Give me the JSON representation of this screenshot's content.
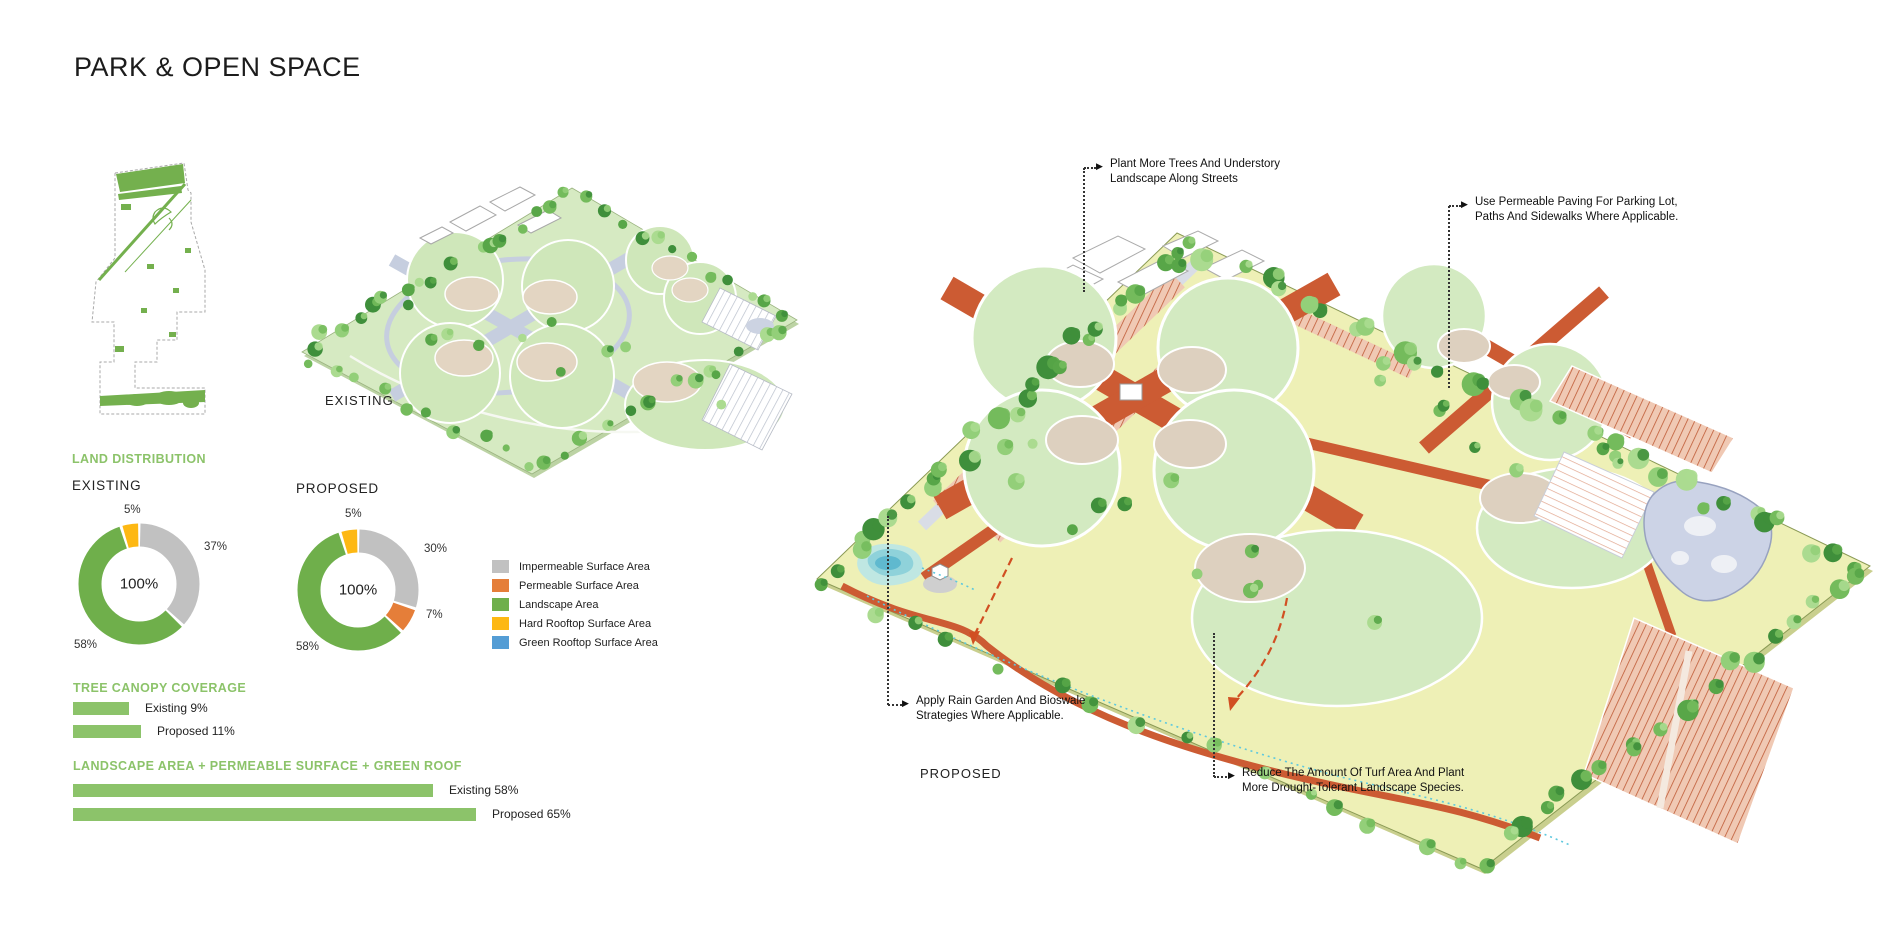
{
  "page": {
    "title": "PARK & OPEN SPACE"
  },
  "plans": {
    "existing_label": "EXISTING",
    "proposed_label": "PROPOSED"
  },
  "colors": {
    "heading_green": "#8CC36A",
    "bar_green": "#8CC36A",
    "impermeable_gray": "#C1C1C1",
    "permeable_orange": "#E57E39",
    "landscape_green": "#6FAF4B",
    "hard_rooftop_yellow": "#FDB813",
    "green_rooftop_blue": "#549DD5",
    "proposed_path_orange": "#CC5B33",
    "proposed_turf": "#EEF0B6",
    "existing_ground": "#D6EAC2",
    "leader_black": "#333333"
  },
  "land_distribution": {
    "heading": "LAND DISTRIBUTION",
    "existing": {
      "label": "EXISTING",
      "center": "100%",
      "segments": [
        {
          "name": "Impermeable Surface Area",
          "value": 37,
          "display": "37%",
          "color": "#C1C1C1"
        },
        {
          "name": "Landscape Area",
          "value": 58,
          "display": "58%",
          "color": "#6FAF4B"
        },
        {
          "name": "Hard Rooftop Surface Area",
          "value": 5,
          "display": "5%",
          "color": "#FDB813"
        }
      ]
    },
    "proposed": {
      "label": "PROPOSED",
      "center": "100%",
      "segments": [
        {
          "name": "Impermeable Surface Area",
          "value": 30,
          "display": "30%",
          "color": "#C1C1C1"
        },
        {
          "name": "Permeable Surface Area",
          "value": 7,
          "display": "7%",
          "color": "#E57E39"
        },
        {
          "name": "Landscape Area",
          "value": 58,
          "display": "58%",
          "color": "#6FAF4B"
        },
        {
          "name": "Hard Rooftop Surface Area",
          "value": 5,
          "display": "5%",
          "color": "#FDB813"
        }
      ]
    }
  },
  "legend": {
    "items": [
      {
        "label": "Impermeable Surface Area",
        "color": "#C1C1C1"
      },
      {
        "label": "Permeable Surface Area",
        "color": "#E57E39"
      },
      {
        "label": "Landscape Area",
        "color": "#6FAF4B"
      },
      {
        "label": "Hard Rooftop Surface Area",
        "color": "#FDB813"
      },
      {
        "label": "Green Rooftop Surface Area",
        "color": "#549DD5"
      }
    ]
  },
  "tree_canopy": {
    "heading": "TREE CANOPY COVERAGE",
    "bars": [
      {
        "label": "Existing 9%",
        "value": 9
      },
      {
        "label": "Proposed 11%",
        "value": 11
      }
    ]
  },
  "landscape_combined": {
    "heading": "LANDSCAPE AREA + PERMEABLE SURFACE + GREEN ROOF",
    "bars": [
      {
        "label": "Existing 58%",
        "value": 58
      },
      {
        "label": "Proposed 65%",
        "value": 65
      }
    ]
  },
  "annotations": {
    "plant_trees": {
      "line1": "Plant More Trees And Understory",
      "line2": "Landscape Along Streets"
    },
    "permeable_paving": {
      "line1": "Use Permeable Paving For Parking Lot,",
      "line2": "Paths And Sidewalks Where Applicable."
    },
    "rain_garden": {
      "line1": "Apply Rain Garden And Bioswale",
      "line2": "Strategies Where Applicable."
    },
    "reduce_turf": {
      "line1": "Reduce The Amount Of Turf Area And Plant",
      "line2": "More Drought-Tolerant Landscape Species."
    }
  },
  "chart_data": [
    {
      "type": "pie",
      "title": "Land Distribution — Existing",
      "labels": [
        "Impermeable Surface Area",
        "Landscape Area",
        "Hard Rooftop Surface Area"
      ],
      "values": [
        37,
        58,
        5
      ],
      "center_label": "100%",
      "legend_position": "right"
    },
    {
      "type": "pie",
      "title": "Land Distribution — Proposed",
      "labels": [
        "Impermeable Surface Area",
        "Permeable Surface Area",
        "Landscape Area",
        "Hard Rooftop Surface Area"
      ],
      "values": [
        30,
        7,
        58,
        5
      ],
      "center_label": "100%",
      "legend_position": "right"
    },
    {
      "type": "bar",
      "title": "Tree Canopy Coverage",
      "categories": [
        "Existing",
        "Proposed"
      ],
      "values": [
        9,
        11
      ],
      "unit": "%"
    },
    {
      "type": "bar",
      "title": "Landscape Area + Permeable Surface + Green Roof",
      "categories": [
        "Existing",
        "Proposed"
      ],
      "values": [
        58,
        65
      ],
      "unit": "%"
    }
  ]
}
